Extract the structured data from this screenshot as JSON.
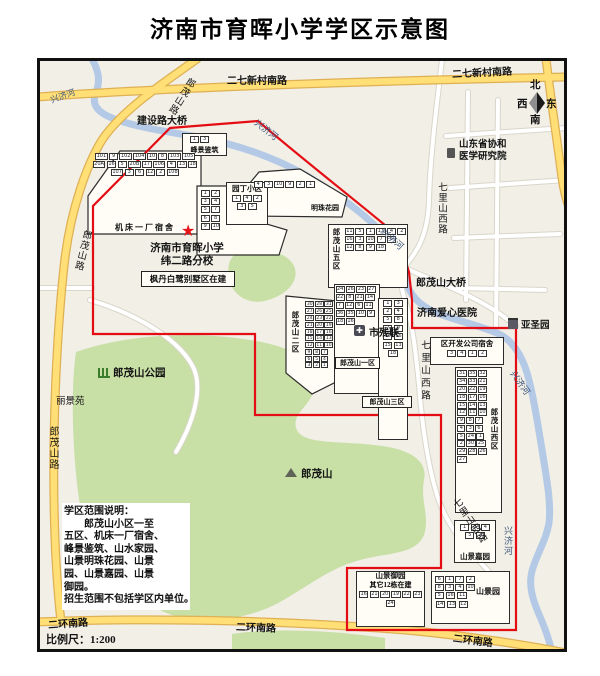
{
  "title": "济南市育晖小学学区示意图",
  "scale_label": "比例尺：1:200",
  "compass": {
    "north": "北",
    "west": "西",
    "east": "东",
    "south": "南"
  },
  "school": {
    "line1": "济南市育晖小学",
    "line2": "纬二路分校"
  },
  "notice": {
    "lines": [
      "学区范围说明：",
      "　　郎茂山小区一至",
      "五区、机床一厂宿舍、",
      "峰景鉴筑、山水家园、",
      "山景明珠花园、山景",
      "园、山景嘉园、山景",
      "御园。",
      "招生范围不包括学区内单位。"
    ]
  },
  "roads": {
    "erqi_a": "二七新村南路",
    "erqi_b": "二七新村南路",
    "langmaoshan_a": "郎茂山路",
    "langmaoshan_b": "郎茂山路",
    "langmaoshan_c": "郎茂山路",
    "erhuan_a": "二环南路",
    "erhuan_b": "二环南路",
    "erhuan_c": "二环南路",
    "qilishan_a": "七里山西路",
    "qilishan_b": "七里山西路",
    "qilishan_c": "七里山西路",
    "jianshe_bridge": "建设路大桥",
    "langmaoshan_bridge": "郎茂山大桥"
  },
  "river_labels": {
    "a": "兴济河",
    "b": "兴济河",
    "c": "兴济河",
    "d": "兴济河",
    "e": "兴济河"
  },
  "places": {
    "hospital": "济南爱心医院",
    "canlian": "市残联",
    "canlian_icon": "✚",
    "yasheng": "亚圣园",
    "academy_line1": "山东省协和",
    "academy_line2": "医学研究院",
    "park": "郎茂山公园",
    "mountain": "郎茂山",
    "lijingyuan": "丽景苑",
    "fengdan": "枫丹白鹭别墅区在建",
    "school_star": "★"
  },
  "colors": {
    "boundary_red": "#e50d14",
    "road_yellow": "#ffdf76",
    "river_blue": "#b3c9e6",
    "park_green": "#c8dfa6",
    "map_bg": "#f1efe6"
  },
  "clusters": [
    {
      "id": "fengjing",
      "label": "峰景鉴筑",
      "buildings": [
        "1",
        "3"
      ]
    },
    {
      "id": "jichuang",
      "label": "机床一厂宿舍",
      "buildings": [
        "101",
        "9",
        "102",
        "104",
        "10",
        "8",
        "103",
        "105",
        "20A",
        "16",
        "5",
        "20B",
        "17",
        "106",
        "4",
        "13",
        "18",
        "107",
        "3",
        "6",
        "12",
        "2",
        "108"
      ]
    },
    {
      "id": "shanshui",
      "label": "山水家园",
      "buildings": [
        "1",
        "2",
        "3",
        "4",
        "5",
        "7",
        "6",
        "8",
        "9",
        "10"
      ]
    },
    {
      "id": "yuanding",
      "label": "园丁小区",
      "buildings": [
        "1",
        "4",
        "2",
        "3",
        "5"
      ]
    },
    {
      "id": "mingzhu",
      "label": "明珠花园",
      "buildings": [
        "4",
        "3",
        "10",
        "9",
        "2",
        "1"
      ]
    },
    {
      "id": "wuqu",
      "label": "郎茂山五区",
      "buildings": [
        "11",
        "5",
        "1",
        "13",
        "4",
        "2",
        "16",
        "3",
        "10",
        "7",
        "6",
        "12",
        "8",
        "9",
        "18"
      ]
    },
    {
      "id": "erqu",
      "label": "郎茂山二区",
      "buildings": [
        "30",
        "28",
        "31",
        "27",
        "26",
        "25",
        "24",
        "23",
        "22",
        "21",
        "20",
        "19",
        "18",
        "17",
        "16",
        "15",
        "14",
        "13",
        "12",
        "11",
        "10",
        "9",
        "8",
        "7",
        "6",
        "5",
        "4",
        "3",
        "2",
        "1"
      ]
    },
    {
      "id": "yiqu",
      "label": "郎茂山一区",
      "buildings": [
        "24",
        "26",
        "23",
        "27",
        "22",
        "8",
        "21",
        "14",
        "7",
        "12",
        "6",
        "11",
        "36",
        "35",
        "10",
        "9",
        "18",
        "16"
      ]
    },
    {
      "id": "sanqu",
      "label": "郎茂山三区",
      "buildings": [
        "1",
        "3",
        "2",
        "4",
        "5",
        "8",
        "7",
        "9",
        "10",
        "16",
        "15",
        "13",
        "18"
      ]
    },
    {
      "id": "kaifa",
      "label": "区开发公司宿舍",
      "buildings": [
        "3",
        "4",
        "1",
        "2"
      ]
    },
    {
      "id": "xiqu",
      "label": "郎茂山西区",
      "buildings": [
        "31",
        "35",
        "32",
        "34",
        "33",
        "21",
        "20",
        "22",
        "19",
        "18",
        "17",
        "16",
        "15",
        "14",
        "13",
        "12",
        "11",
        "10",
        "9",
        "8",
        "7",
        "4",
        "3",
        "6",
        "5",
        "24",
        "1",
        "2",
        "30",
        "25",
        "29",
        "28",
        "26",
        "27"
      ]
    },
    {
      "id": "jiayuan",
      "label": "山景嘉园",
      "buildings": [
        "1",
        "3",
        "4",
        "5",
        "2"
      ]
    },
    {
      "id": "yuyuan",
      "label": "山景御园",
      "label2": "其它12栋在建",
      "buildings": [
        "16",
        "21",
        "20",
        "19",
        "22",
        "23",
        "24"
      ]
    },
    {
      "id": "jingyuan",
      "label": "山景园",
      "buildings": [
        "6",
        "1",
        "7",
        "2",
        "8",
        "3",
        "4",
        "10",
        "5",
        "16",
        "11",
        "14",
        "13",
        "12"
      ]
    },
    {
      "id": "lijing",
      "label": "丽景苑",
      "buildings": []
    }
  ]
}
